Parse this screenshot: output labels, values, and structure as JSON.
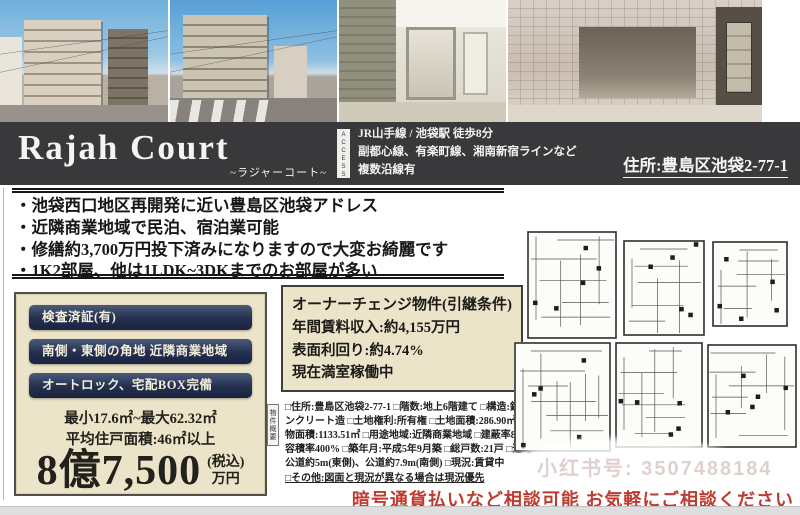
{
  "header": {
    "title": "Rajah Court",
    "subtitle": "~ラジャーコート~",
    "access_label": "A C C E S S",
    "access_line1": "JR山手線 / 池袋駅 徒歩8分",
    "access_line2": "副都心線、有楽町線、湘南新宿ラインなど",
    "access_line3": "複数沿線有",
    "address": "住所:豊島区池袋2-77-1"
  },
  "highlights": [
    "・池袋西口地区再開発に近い豊島区池袋アドレス",
    "・近隣商業地域で民泊、宿泊業可能",
    "・修繕約3,700万円投下済みになりますので大変お綺麗です",
    "・1K2部屋、他は1LDK~3DKまでのお部屋が多い"
  ],
  "price_box": {
    "badge1": "検査済証(有)",
    "badge2": "南側・東側の角地 近隣商業地域",
    "badge3": "オートロック、宅配BOX完備",
    "size_range": "最小17.6㎡~最大62.32㎡",
    "average_area": "平均住戸面積:46㎡以上",
    "price_main": "8億7,500",
    "price_tax": "(税込)",
    "price_unit": "万円"
  },
  "income_box": {
    "line1": "オーナーチェンジ物件(引継条件)",
    "line2": "年間賃料収入:約4,155万円",
    "line3": "表面利回り:約4.74%",
    "line4": "現在満室稼働中"
  },
  "overview": {
    "label": "物件概要",
    "details": "□住所:豊島区池袋2-77-1 □階数:地上6階建て □構造:鉄筋コンクリート造 □土地権利:所有権 □土地面積:286.90㎡ □建物面積:1133.51㎡ □用途地域:近隣商業地域 □建蔽率80% □容積率400% □築年月:平成5年9月築 □総戸数:21戸 □道路:公道約5m(東側)、公道約7.9m(南側) □現況:賃貸中",
    "other": "□その他:図面と現況が異なる場合は現況優先"
  },
  "watermark": "小红书号: 3507488184",
  "notice": "暗号通貨払いなど相談可能 お気軽にご相談ください",
  "colors": {
    "titlebar_bg": "#39383a",
    "box_cream": "#ece4c9",
    "badge_navy": "#232f4e",
    "notice_red": "#bf3a30"
  }
}
